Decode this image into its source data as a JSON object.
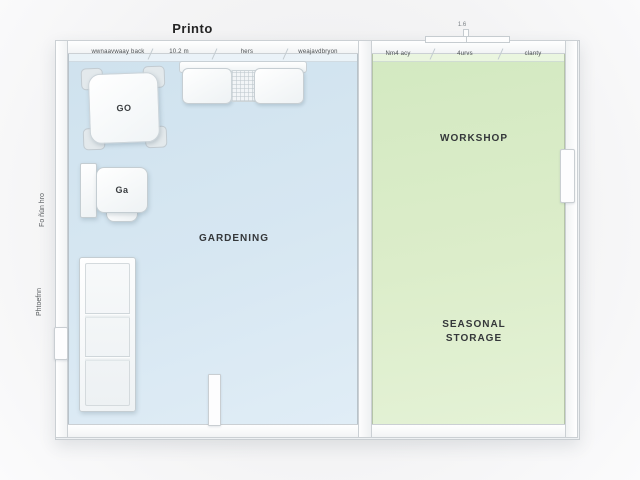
{
  "title": "Printo",
  "colors": {
    "background": "#f1f1f2",
    "floor_gardening": "#d6e7f1",
    "floor_workshop": "#dcedcb",
    "wall": "#fbfbfc",
    "wall_border": "#c9ced2",
    "label_text": "#34373a"
  },
  "rooms": {
    "gardening": {
      "label": "GARDENING"
    },
    "workshop": {
      "label": "WORKSHOP"
    },
    "seasonal_storage": {
      "label_line1": "SEASONAL",
      "label_line2": "STORAGE"
    }
  },
  "wall_annotations": {
    "top_left_room": [
      "wwnaavwaay back",
      "10.2 m",
      "hers",
      "weajavdbryon"
    ],
    "top_right_room": [
      "Nm4 acy",
      "4urvs",
      "clanty"
    ],
    "left_side_vertical": [
      "Fo ñün hro",
      "Phtoefnn"
    ],
    "top_right_dimension": "1.6"
  },
  "furniture": {
    "square_table": {
      "label": "GO"
    },
    "side_unit": {
      "label": "Ga"
    }
  }
}
